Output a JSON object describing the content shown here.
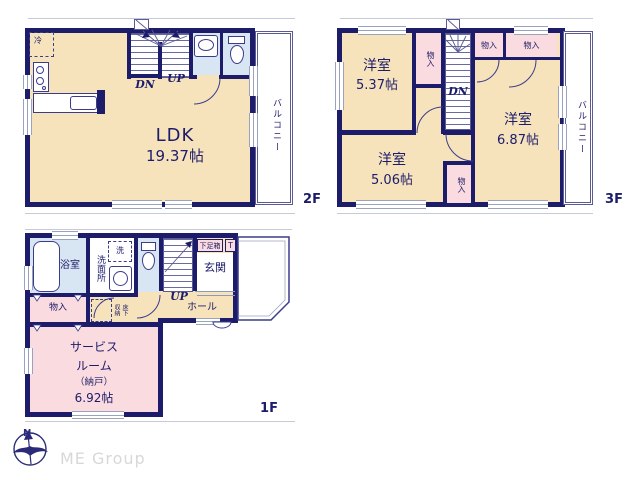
{
  "colors": {
    "wall_navy": "#1c1c6a",
    "room_cream": "#f6e3bc",
    "closet_pink": "#fadce0",
    "wet_area_blue": "#d8e5f2",
    "brand_gray": "#d8d8d8"
  },
  "floor2": {
    "floor_label": "2F",
    "ldk_name": "LDK",
    "ldk_size": "19.37帖",
    "balcony": "バルコニー",
    "dn": "DN",
    "up": "UP",
    "fridge": "冷"
  },
  "floor3": {
    "floor_label": "3F",
    "room_a_name": "洋室",
    "room_a_size": "5.37帖",
    "room_b_name": "洋室",
    "room_b_size": "6.87帖",
    "room_c_name": "洋室",
    "room_c_size": "5.06帖",
    "closet_left": "物入",
    "closet_top_1": "物入",
    "closet_top_2": "物入",
    "closet_bottom": "物入",
    "balcony": "バルコニー",
    "dn": "DN"
  },
  "floor1": {
    "floor_label": "1F",
    "bath": "浴室",
    "washroom": "洗面所",
    "washer": "洗",
    "shoe_box": "下足箱",
    "shoe_box_t": "T",
    "entrance": "玄関",
    "hall": "ホール",
    "up": "UP",
    "closet": "物入",
    "underfloor_right": "床下",
    "underfloor_left": "収納",
    "service_line1": "サービス",
    "service_line2": "ルーム",
    "service_line3": "（納戸）",
    "service_size": "6.92帖"
  },
  "footer": {
    "brand": "ME Group",
    "compass_north": "N"
  }
}
